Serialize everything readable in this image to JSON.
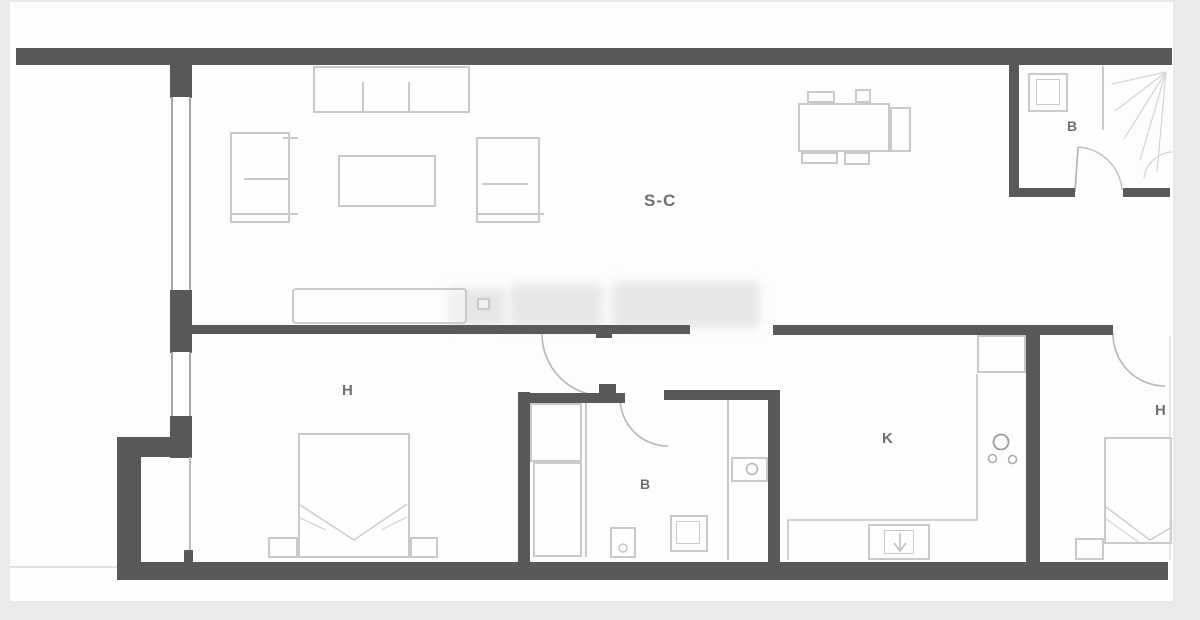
{
  "document": {
    "type": "apartment-floor-plan",
    "colors": {
      "background": "#e9e9e8",
      "plan_background": "#fdfdfd",
      "wall": "#58595b",
      "furniture_line": "#c9c9c9",
      "label": "#6e7072"
    }
  },
  "rooms": [
    {
      "id": "living-dining",
      "label": "S-C"
    },
    {
      "id": "bedroom-1",
      "label": "H"
    },
    {
      "id": "bathroom-1",
      "label": "B"
    },
    {
      "id": "kitchen",
      "label": "K"
    },
    {
      "id": "bedroom-2",
      "label": "H"
    },
    {
      "id": "bathroom-2",
      "label": "B"
    }
  ]
}
